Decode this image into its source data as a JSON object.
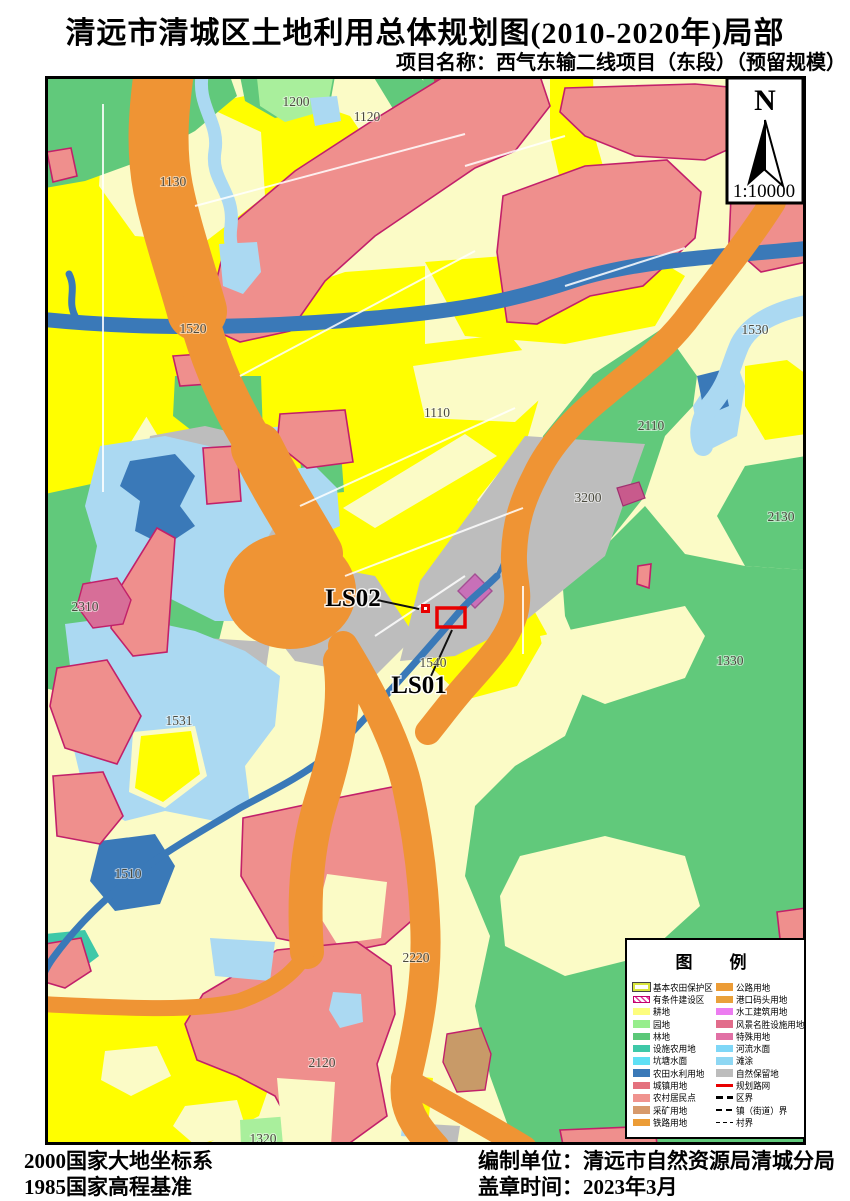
{
  "page": {
    "title": "清远市清城区土地利用总体规划图(2010-2020年)局部",
    "subtitle": "项目名称：西气东输二线项目（东段）（预留规模）"
  },
  "compass": {
    "label": "N",
    "scale": "1:10000"
  },
  "map": {
    "labels": [
      {
        "text": "1200",
        "x": 251,
        "y": 30
      },
      {
        "text": "1120",
        "x": 322,
        "y": 45
      },
      {
        "text": "1130",
        "x": 128,
        "y": 110
      },
      {
        "text": "1520",
        "x": 148,
        "y": 257
      },
      {
        "text": "1530",
        "x": 710,
        "y": 258
      },
      {
        "text": "1110",
        "x": 392,
        "y": 341
      },
      {
        "text": "2110",
        "x": 606,
        "y": 354
      },
      {
        "text": "3200",
        "x": 543,
        "y": 426
      },
      {
        "text": "2130",
        "x": 736,
        "y": 445
      },
      {
        "text": "2310",
        "x": 40,
        "y": 535,
        "size": 11
      },
      {
        "text": "1540",
        "x": 388,
        "y": 591,
        "size": 11
      },
      {
        "text": "1330",
        "x": 685,
        "y": 589
      },
      {
        "text": "1531",
        "x": 134,
        "y": 649
      },
      {
        "text": "1510",
        "x": 83,
        "y": 802
      },
      {
        "text": "2220",
        "x": 371,
        "y": 886
      },
      {
        "text": "2120",
        "x": 277,
        "y": 991
      },
      {
        "text": "1320",
        "x": 218,
        "y": 1067,
        "color": "#1F8A3D"
      },
      {
        "text": "LS02",
        "x": 308,
        "y": 530,
        "cls": "big"
      },
      {
        "text": "LS01",
        "x": 374,
        "y": 617,
        "cls": "big"
      }
    ]
  },
  "legend": {
    "title": "图　例",
    "left": [
      {
        "label": "基本农田保护区",
        "swatch": "openbox",
        "color": "#D9E53C"
      },
      {
        "label": "有条件建设区",
        "swatch": "hatch",
        "color": "#C2006C"
      },
      {
        "label": "耕地",
        "swatch": "box",
        "color": "#FDFD7E"
      },
      {
        "label": "园地",
        "swatch": "box",
        "color": "#97EE8C"
      },
      {
        "label": "林地",
        "swatch": "box",
        "color": "#5BC878"
      },
      {
        "label": "设施农用地",
        "swatch": "box",
        "color": "#3EC8A8"
      },
      {
        "label": "坑塘水面",
        "swatch": "box",
        "color": "#5FE0F5"
      },
      {
        "label": "农田水利用地",
        "swatch": "box",
        "color": "#3A79B8"
      },
      {
        "label": "城镇用地",
        "swatch": "box",
        "color": "#E4717E"
      },
      {
        "label": "农村居民点",
        "swatch": "box",
        "color": "#F0938F"
      },
      {
        "label": "采矿用地",
        "swatch": "box",
        "color": "#D79A6C"
      },
      {
        "label": "铁路用地",
        "swatch": "box",
        "color": "#EC9C36"
      }
    ],
    "right": [
      {
        "label": "公路用地",
        "swatch": "box",
        "color": "#EC9C36"
      },
      {
        "label": "港口码头用地",
        "swatch": "box",
        "color": "#E9A13B"
      },
      {
        "label": "水工建筑用地",
        "swatch": "box",
        "color": "#EC7CF0"
      },
      {
        "label": "风景名胜设施用地",
        "swatch": "box",
        "color": "#E26C8B"
      },
      {
        "label": "特殊用地",
        "swatch": "box",
        "color": "#E170A5"
      },
      {
        "label": "河流水面",
        "swatch": "box",
        "color": "#7FD7F7"
      },
      {
        "label": "滩涂",
        "swatch": "box",
        "color": "#8ED7F3"
      },
      {
        "label": "自然保留地",
        "swatch": "box",
        "color": "#BDBDBD"
      },
      {
        "label": "规划路网",
        "swatch": "redline",
        "color": "#E80000"
      },
      {
        "label": "区界",
        "swatch": "dashbold",
        "color": "#000000"
      },
      {
        "label": "镇（街道）界",
        "swatch": "dashmed",
        "color": "#000000"
      },
      {
        "label": "村界",
        "swatch": "dashthin",
        "color": "#000000"
      }
    ]
  },
  "footer": {
    "datum1": "2000国家大地坐标系",
    "datum2": "1985国家高程基准",
    "agency": "编制单位：清远市自然资源局清城分局",
    "seal": "盖章时间：2023年3月"
  },
  "palette": {
    "bright_farmland_reserve": "#FFFE00",
    "cropland_pale": "#FBFBC6",
    "forest_green": "#61C97B",
    "orchard_light_green": "#A9EF9C",
    "road_orange": "#EF9434",
    "settlement_pink": "#EF8F8D",
    "settlement_outline_magenta": "#C2206A",
    "water_light_blue": "#ABD9F2",
    "water_steel_blue": "#3A79B8",
    "reserved_gray": "#BDBDBD",
    "planning_red": "#E80000"
  }
}
